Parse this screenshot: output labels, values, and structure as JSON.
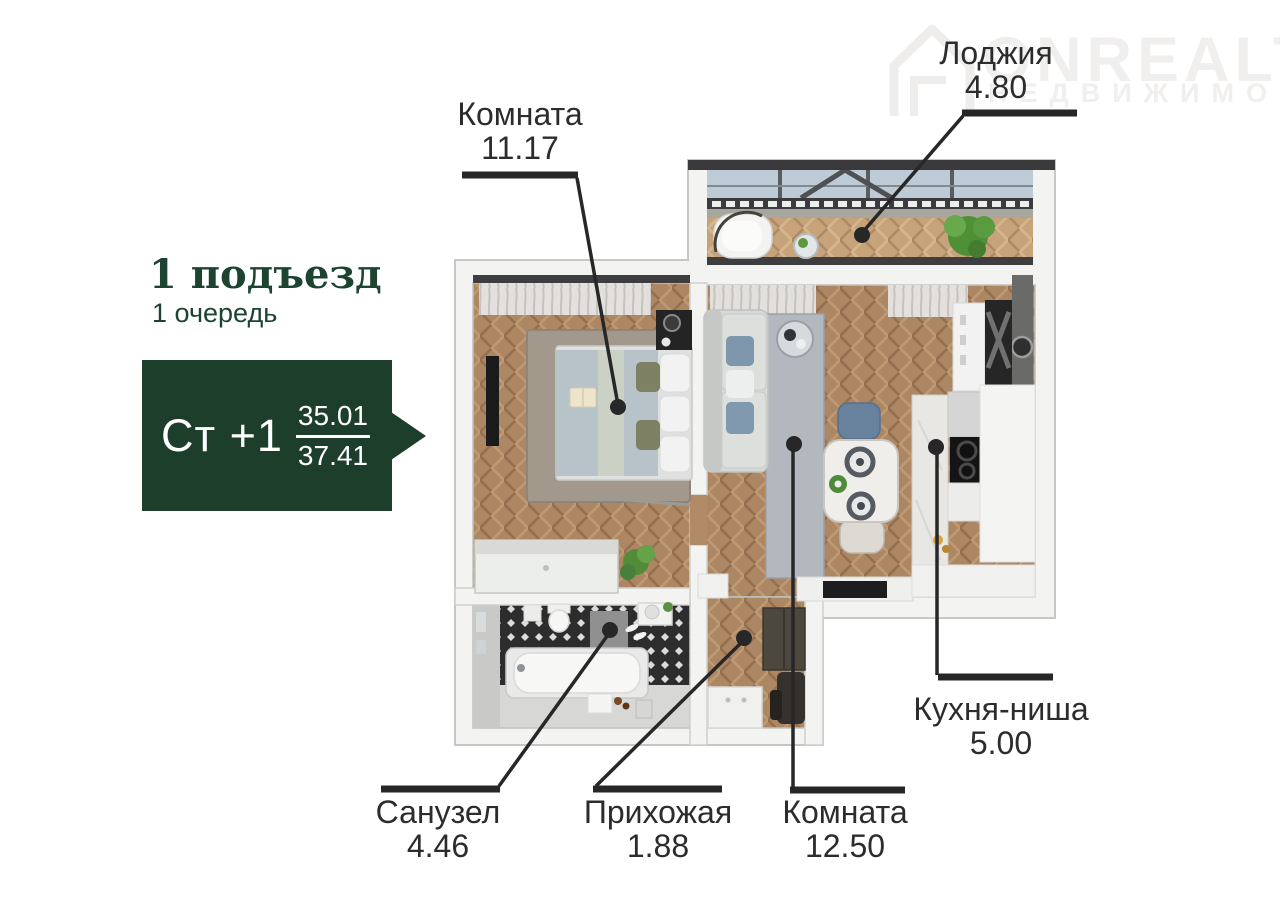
{
  "watermark": {
    "brand": "ONREALT",
    "subtitle": "НЕДВИЖИМОСТЬ"
  },
  "header": {
    "line1": "1 подъезд",
    "line2": "1 очередь"
  },
  "badge": {
    "plan_type": "Ст +1",
    "area_living": "35.01",
    "area_total": "37.41"
  },
  "rooms": [
    {
      "name": "Комната",
      "area": "11.17"
    },
    {
      "name": "Лоджия",
      "area": "4.80"
    },
    {
      "name": "Комната",
      "area": "12.50"
    },
    {
      "name": "Кухня-ниша",
      "area": "5.00"
    },
    {
      "name": "Прихожая",
      "area": "1.88"
    },
    {
      "name": "Санузел",
      "area": "4.46"
    }
  ],
  "colors": {
    "badge_green": "#1e3e2c",
    "heading_green": "#1c4430",
    "label_text": "#2c2c2c",
    "leader_line": "#272727",
    "wood_floor": "#ad8663",
    "loggia_floor": "#c6a37b",
    "wall": "#f3f3f2"
  }
}
